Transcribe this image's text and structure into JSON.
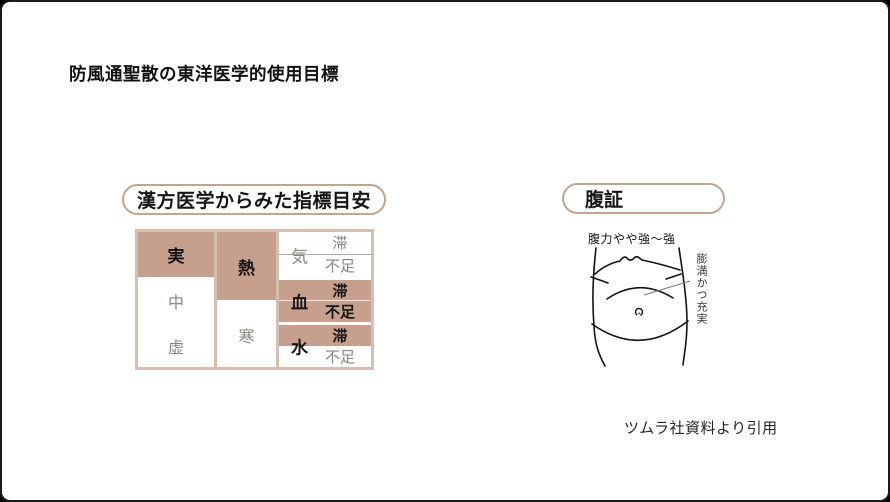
{
  "title": "防風通聖散の東洋医学的使用目標",
  "kampo_panel": {
    "header": "漢方医学からみた指標目安",
    "table": {
      "kyojitsu": [
        {
          "label": "実",
          "selected": true
        },
        {
          "label": "中",
          "selected": false
        },
        {
          "label": "虚",
          "selected": false
        }
      ],
      "netsukan": [
        {
          "label": "熱",
          "selected": true
        },
        {
          "label": "寒",
          "selected": false
        }
      ],
      "kiketsusui": [
        {
          "label": "気",
          "selected": false,
          "sub": [
            {
              "label": "滞",
              "selected": false
            },
            {
              "label": "不足",
              "selected": false
            }
          ]
        },
        {
          "label": "血",
          "selected": true,
          "sub": [
            {
              "label": "滞",
              "selected": true
            },
            {
              "label": "不足",
              "selected": true
            }
          ]
        },
        {
          "label": "水",
          "selected": true,
          "sub": [
            {
              "label": "滞",
              "selected": true
            },
            {
              "label": "不足",
              "selected": false
            }
          ]
        }
      ]
    }
  },
  "fukusho_panel": {
    "header": "腹証",
    "abdominal_strength": "腹力やや強〜強",
    "annotation": "膨満かつ充実",
    "figure": "abdomen-outline-drawing"
  },
  "citation": "ツムラ社資料より引用",
  "colors": {
    "highlight_brown": "#c6a08c",
    "table_gap_tan": "#d5bfb0",
    "muted_text": "#8a867f",
    "strong_text": "#141414",
    "pill_border": "#c2a58e",
    "frame_border": "#1a1a1a"
  }
}
